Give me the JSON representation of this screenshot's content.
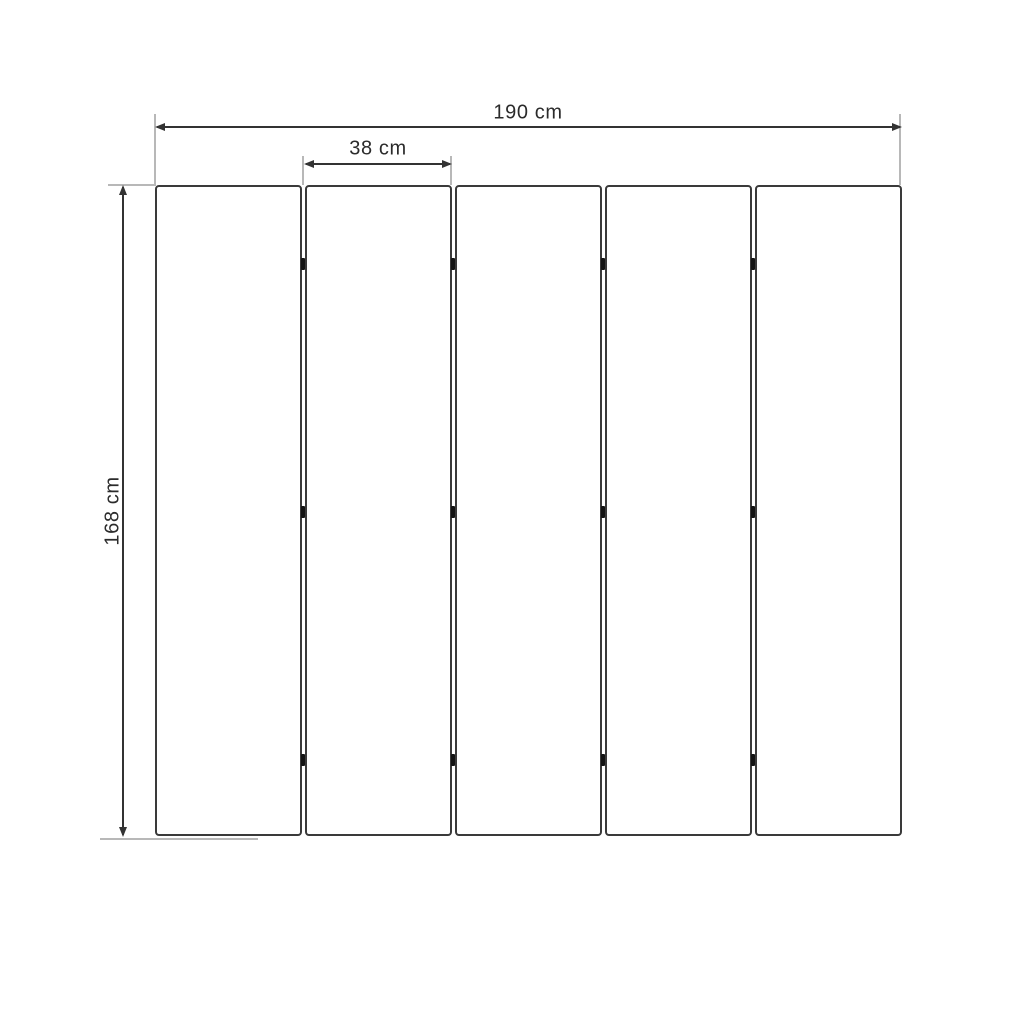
{
  "drawing": {
    "type": "technical-dimension-drawing",
    "subject": "five-panel folding screen, front elevation",
    "labels": {
      "total_width": "190 cm",
      "panel_width": "38 cm",
      "height": "168 cm"
    },
    "panel_count": 5,
    "hinges_per_gap": 3,
    "colors": {
      "line": "#333333",
      "extension_line": "#b8b8b8",
      "hinge": "#141414",
      "text": "#2b2b2b",
      "background": "#ffffff"
    }
  }
}
